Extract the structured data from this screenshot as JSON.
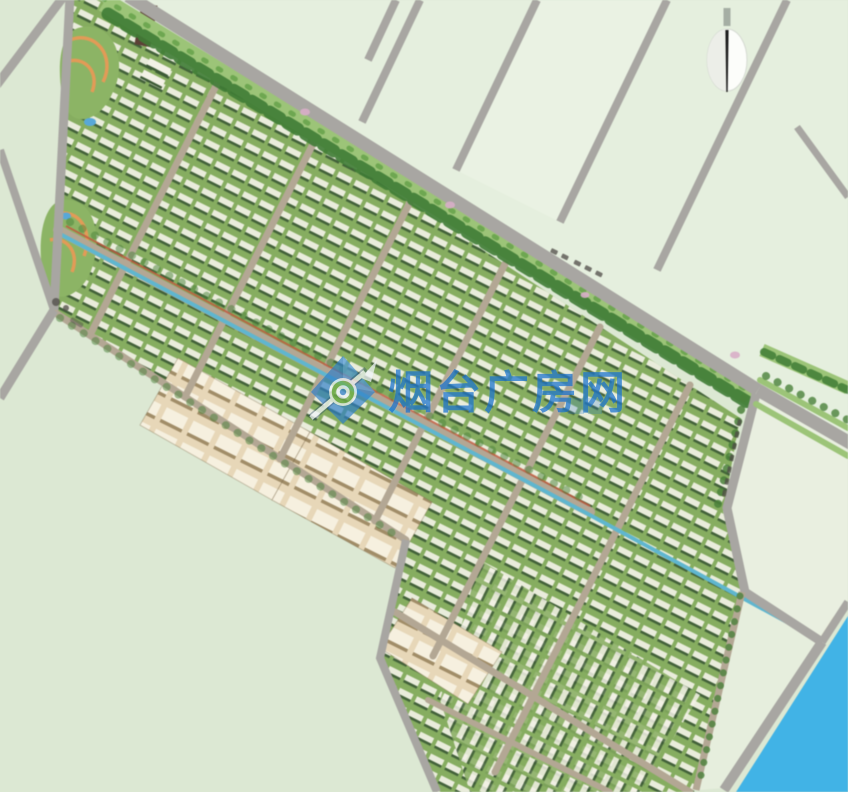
{
  "watermark": {
    "text": "烟台广房网",
    "logo": "diamond-ring-arrow-logo"
  },
  "compass": {
    "type": "north-arrow",
    "points": "N"
  },
  "road_labels": [
    {
      "id": "main-road-label",
      "legibility": "illegible-small-dark-characters"
    },
    {
      "id": "east-boundary-road-label",
      "legibility": "illegible-small-dark-characters"
    }
  ],
  "colors": {
    "field": "#dce8d3",
    "fieldLight": "#e5efde",
    "fieldPale": "#e9efe0",
    "road": "#a8a6a2",
    "street": "#b3a794",
    "devGreen": "#86ad60",
    "beltGreen": "#9cc478",
    "treeDark": "#3f7c35",
    "treeMid": "#4a8139",
    "roofWhite": "#f2f1e6",
    "roofShadow": "#3c5a36",
    "beige": "#e7d7b8",
    "beigeRoof": "#f6f0df",
    "beigeShadow": "#a18d68",
    "canal": "#5fb6cf",
    "river": "#41b3e6",
    "pathOrange": "#e29b57",
    "accentRed": "#c05a40",
    "pondBlue": "#58a8d8",
    "wmBlue": "#1d74cf",
    "flowerPink": "#d8aec8"
  }
}
